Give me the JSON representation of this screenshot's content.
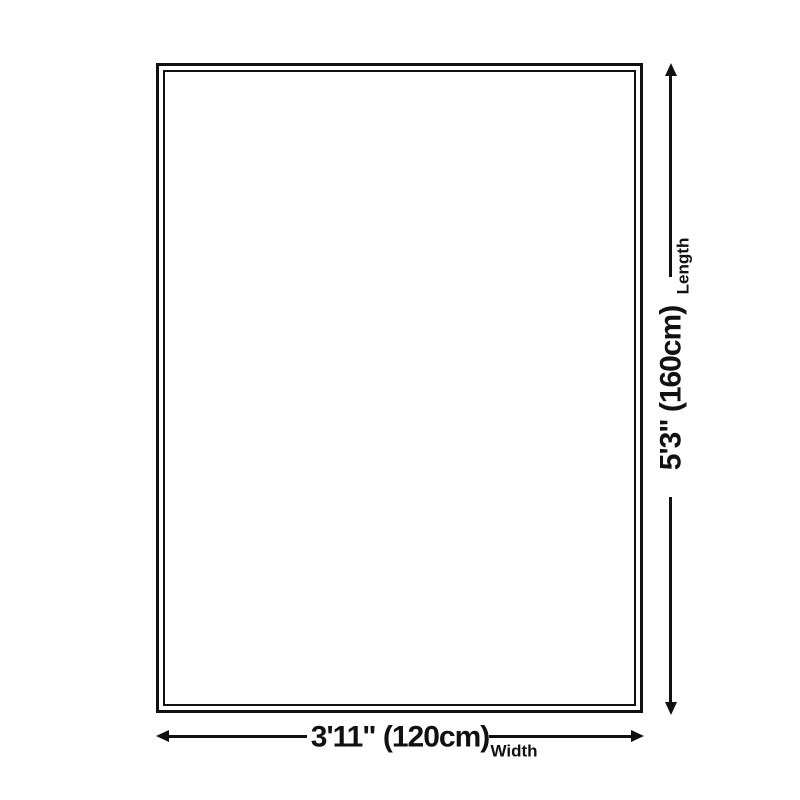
{
  "diagram": {
    "type": "product-size-diagram",
    "shape": "rectangle",
    "colors": {
      "line": "#111111",
      "background": "#ffffff"
    },
    "icons": {
      "arrow_up": "css-triangle-up",
      "arrow_down": "css-triangle-down",
      "arrow_left": "css-triangle-left",
      "arrow_right": "css-triangle-right"
    }
  },
  "length_dimension": {
    "value": "5'3\" (160cm)",
    "label": "Length"
  },
  "width_dimension": {
    "value": "3'11\" (120cm)",
    "label": "Width"
  }
}
